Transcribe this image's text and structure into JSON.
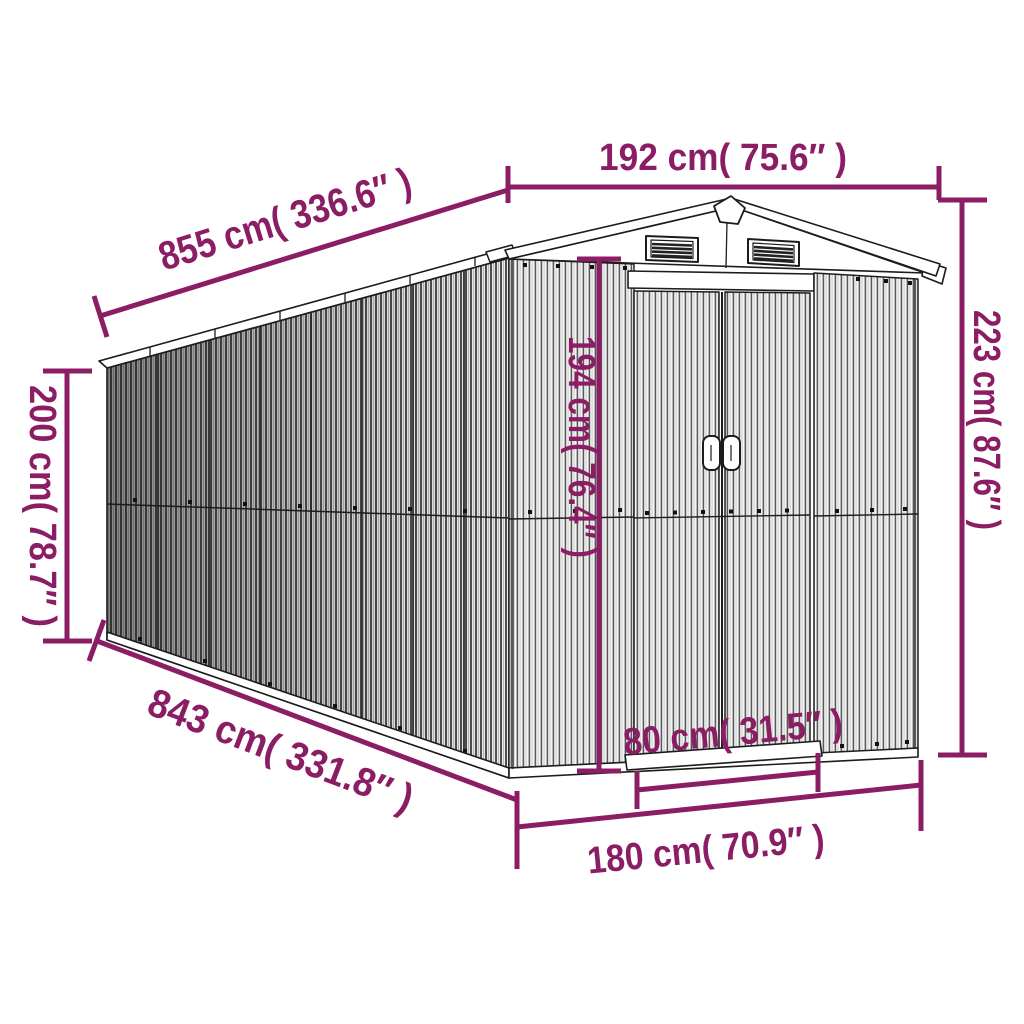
{
  "image": {
    "type": "product-dimension-diagram",
    "subject": "metal garden storage shed line drawing",
    "accent_color": "#8b1d64",
    "line_color": "#1c1c1c",
    "background_color": "#ffffff"
  },
  "dimensions": {
    "roof_length": {
      "label": "855 cm( 336.6″ )",
      "value_cm": 855,
      "value_in": 336.6
    },
    "front_width_top": {
      "label": "192 cm( 75.6″ )",
      "value_cm": 192,
      "value_in": 75.6
    },
    "rear_wall_height": {
      "label": "200 cm( 78.7″ )",
      "value_cm": 200,
      "value_in": 78.7
    },
    "total_height": {
      "label": "223 cm( 87.6″ )",
      "value_cm": 223,
      "value_in": 87.6
    },
    "door_height": {
      "label": "194 cm( 76.4″ )",
      "value_cm": 194,
      "value_in": 76.4
    },
    "base_length": {
      "label": "843 cm( 331.8″ )",
      "value_cm": 843,
      "value_in": 331.8
    },
    "door_width": {
      "label": "80 cm( 31.5″ )",
      "value_cm": 80,
      "value_in": 31.5
    },
    "front_width_base": {
      "label": "180 cm( 70.9″ )",
      "value_cm": 180,
      "value_in": 70.9
    }
  }
}
